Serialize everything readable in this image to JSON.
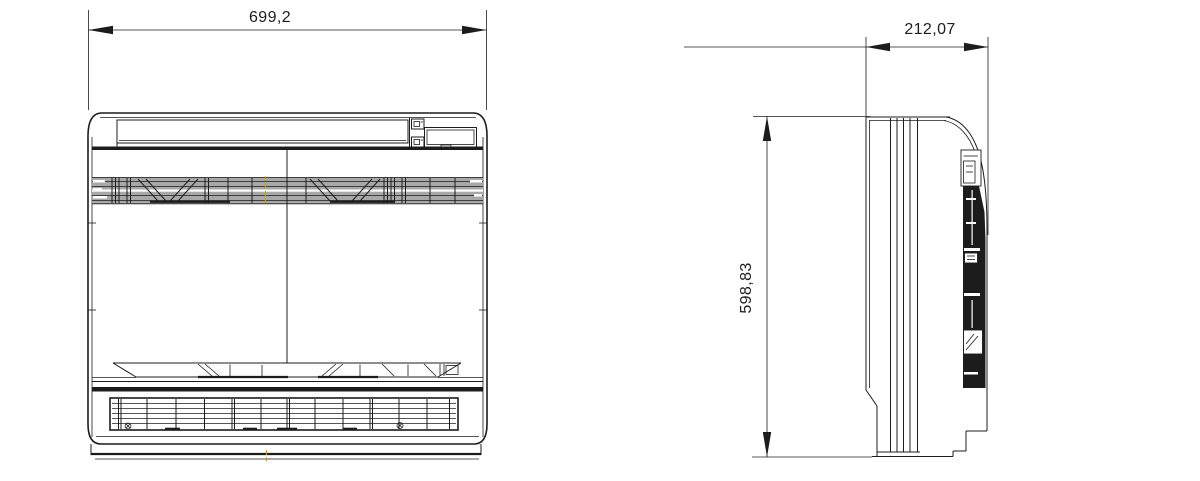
{
  "drawing": {
    "background": "#ffffff",
    "line_color": "#1c1c1c",
    "grille_fill": "#a8a8a8",
    "accent_color": "#d79500",
    "dimensions": {
      "width": "699,2",
      "depth": "212,07",
      "height": "598,83"
    },
    "icons": {
      "screw": "circle-with-cross",
      "control_buttons": "small-square-switches"
    }
  }
}
